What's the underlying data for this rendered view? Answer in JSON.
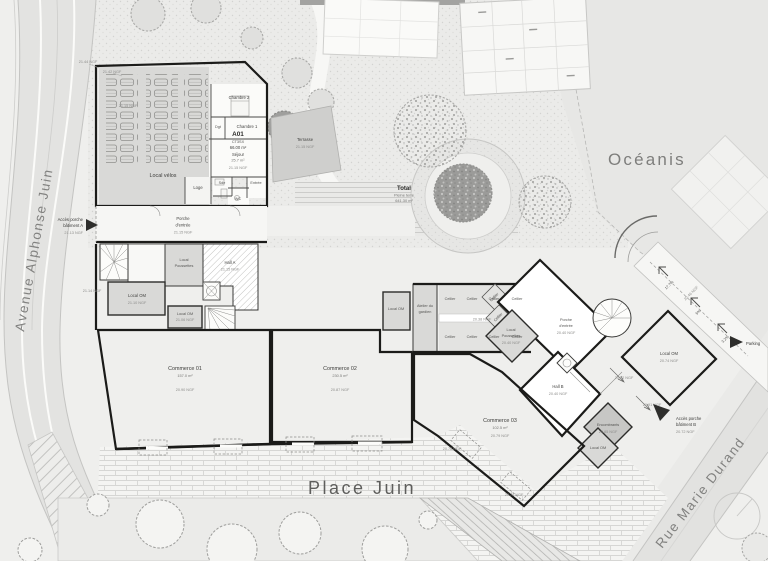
{
  "streets": {
    "avenue": "Avenue Alphonse Juin",
    "rue": "Rue Marie Durand",
    "place": "Place Juin",
    "oceanis": "Océanis",
    "parking": "Parking"
  },
  "garden": {
    "total": "Total",
    "sub": "Pleine terre",
    "area": "641.30 m²"
  },
  "accessA": {
    "l1": "Accès porche",
    "l2": "bâtiment A",
    "ngf": "21.13 NGF"
  },
  "accessB": {
    "l1": "Accès porche",
    "l2": "bâtiment B",
    "ngf": "20.72 NGF"
  },
  "apartment": {
    "id": "A01",
    "type": "CT3SX",
    "area": "66.00 m²",
    "room": "Séjour",
    "room_area": "25.7 m²",
    "ngf": "21.15 NGF"
  },
  "roomsA": {
    "velos": "Local vélos",
    "velos_ngf": "21.15 NGF",
    "chambre2": "Chambre 2",
    "chambre1": "Chambre 1",
    "dgt": "Dgt",
    "loge": "Loge",
    "sde": "Sde",
    "wc": "WC",
    "entree": "Entrée",
    "terrasse": "Terrasse",
    "terrasse_ngf": "21.15 NGF",
    "porche_l1": "Porche",
    "porche_l2": "d'entrée",
    "porche_ngf": "21.15 NGF",
    "hall": "Hall A",
    "hall_ngf": "21.15 NGF",
    "pouss_l1": "Local",
    "pouss_l2": "Poussettes",
    "om1": "Local OM",
    "om1_ngf": "21.10 NGF",
    "om2": "Local OM",
    "om2_ngf": "21.06 NGF"
  },
  "commerces": [
    {
      "name": "Commerce 01",
      "area": "157.0 m²",
      "ngf": "20.90 NGF"
    },
    {
      "name": "Commerce 02",
      "area": "230.5 m²",
      "ngf": "20.87 NGF"
    },
    {
      "name": "Commerce 03",
      "area": "102.5 m²",
      "ngf": "20.79 NGF"
    }
  ],
  "service": {
    "om": "Local OM",
    "atelier_l1": "Atelier du",
    "atelier_l2": "gardien",
    "cellier": "Cellier",
    "corridor_ngf": "20.38 NGF"
  },
  "buildingB": {
    "porche_l1": "Porche",
    "porche_l2": "d'entrée",
    "porche_ngf": "20.40 NGF",
    "hall": "Hall B",
    "hall_ngf": "20.40 NGF",
    "pouss_l1": "Local",
    "pouss_l2": "Poussettes",
    "pouss_ngf": "20.40 NGF",
    "om_right": "Local OM",
    "om_right_ngf": "20.74 NGF",
    "om_bottom": "Local OM",
    "encombrants": "Encombrants",
    "enc_ngf": "20.85 NGF"
  },
  "elevations": {
    "e2144": "21.44 NGF",
    "e2142": "21.42 NGF",
    "e2114": "21.14 NGF",
    "e2082": "20.82 NGF",
    "e2091": "20.91 NGF",
    "e2046": "20.46 NGF",
    "e2078": "20.78 NGF",
    "e2076": "20.76 NGF"
  },
  "ramp": {
    "p1": "17.7%",
    "p2": "5%",
    "p3": "3.2%"
  }
}
